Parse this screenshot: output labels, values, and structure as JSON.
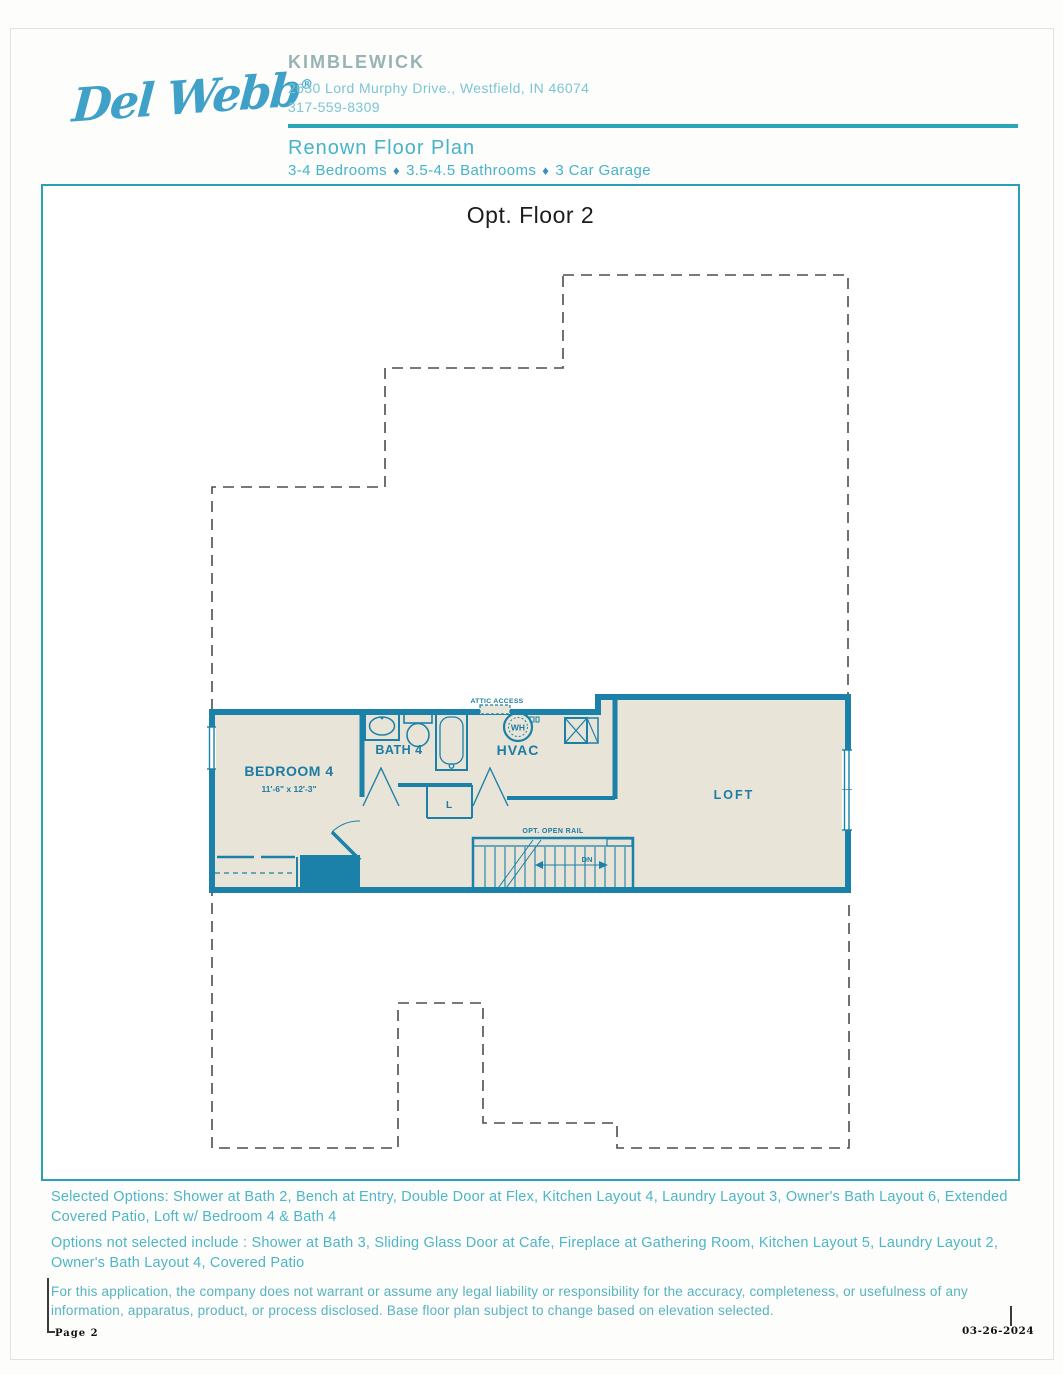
{
  "header": {
    "logo_text": "Del Webb",
    "logo_mark": "®",
    "community_name": "KIMBLEWICK",
    "address": "2630 Lord Murphy Drive., Westfield, IN 46074",
    "phone": "317-559-8309",
    "plan_name": "Renown Floor Plan",
    "specs": {
      "bedrooms": "3-4 Bedrooms",
      "bathrooms": "3.5-4.5 Bathrooms",
      "garage": "3 Car Garage",
      "separator": "♦"
    }
  },
  "plan": {
    "title": "Opt. Floor 2",
    "rooms": {
      "bedroom4": {
        "name": "BEDROOM 4",
        "dims": "11'-6\" x 12'-3\""
      },
      "bath4": {
        "name": "BATH 4"
      },
      "hvac": {
        "name": "HVAC"
      },
      "loft": {
        "name": "LOFT"
      }
    },
    "annotations": {
      "attic_access": "ATTIC ACCESS",
      "water_heater": "WH",
      "linen": "L",
      "open_rail": "OPT. OPEN RAIL",
      "down": "DN"
    }
  },
  "options": {
    "selected": "Selected Options: Shower at Bath 2, Bench at Entry, Double Door at Flex, Kitchen Layout 4, Laundry Layout 3, Owner's Bath Layout 6, Extended Covered Patio, Loft w/ Bedroom 4 & Bath 4",
    "not_selected": "Options not selected include : Shower at Bath 3, Sliding Glass Door at Cafe, Fireplace at Gathering Room, Kitchen Layout 5, Laundry Layout 2, Owner's Bath Layout 4, Covered Patio",
    "disclaimer": "For this application, the company does not warrant or assume any legal liability or responsibility for the accuracy, completeness, or usefulness of any information, apparatus, product, or process disclosed. Base floor plan subject to change based on elevation selected."
  },
  "footer": {
    "page_label": "Page 2",
    "date": "03-26-2024"
  },
  "colors": {
    "wall_teal": "#1b81a9",
    "room_fill": "#e8e4d7",
    "header_teal": "#46b3ca",
    "address_teal": "#7cc5d4",
    "community_gray": "#97b3b4",
    "logo_blue": "#3fa0c8",
    "rule_teal": "#2aa6b8",
    "outline_gray": "#4d4d4d",
    "body_text_teal": "#4db6c6",
    "title_black": "#1c1c1c"
  }
}
